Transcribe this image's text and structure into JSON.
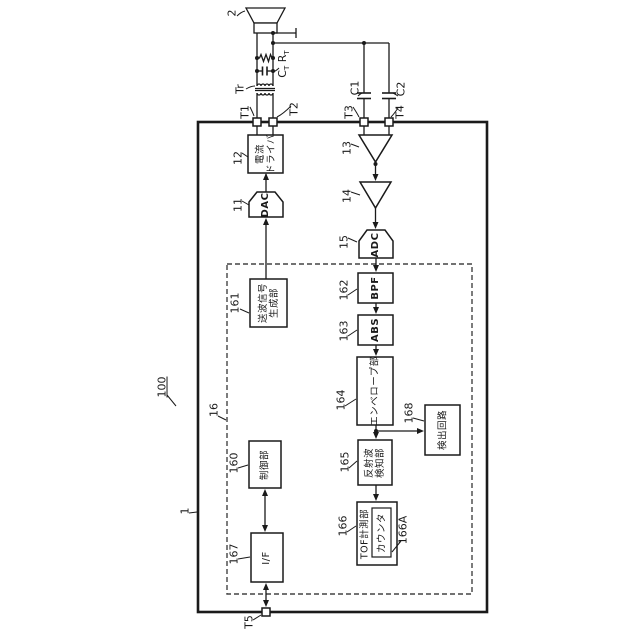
{
  "labels": {
    "transducer_ref": "2",
    "transformer_ref": "Tr",
    "ct": "C",
    "ct_sub": "T",
    "rt": "R",
    "rt_sub": "T",
    "t1": "T1",
    "t2": "T2",
    "t3": "T3",
    "t4": "T4",
    "t5": "T5",
    "c1": "C1",
    "c2": "C2",
    "system_ref": "100",
    "device_ref": "1",
    "chip_ref": "16",
    "dac_ref": "11",
    "driver_ref": "12",
    "amp1_ref": "13",
    "amp2_ref": "14",
    "adc_ref": "15",
    "control_ref": "160",
    "txgen_ref": "161",
    "bpf_ref": "162",
    "abs_ref": "163",
    "env_ref": "164",
    "reflect_ref": "165",
    "tof_ref": "166",
    "counter_ref": "166A",
    "if_ref": "167",
    "detect_ref": "168"
  },
  "blocks": {
    "current_driver": "電流\nドライバ",
    "dac": "DAC",
    "adc": "ADC",
    "bpf": "BPF",
    "abs": "ABS",
    "envelope": "エンベロープ部",
    "tx_signal_gen": "送波信号\n生成部",
    "control": "制御部",
    "interface": "I/F",
    "reflected_wave_detect": "反射波\n検知部",
    "tof_measure": "TOF計測部",
    "counter": "カウンタ",
    "detection_circuit": "検出回路"
  }
}
